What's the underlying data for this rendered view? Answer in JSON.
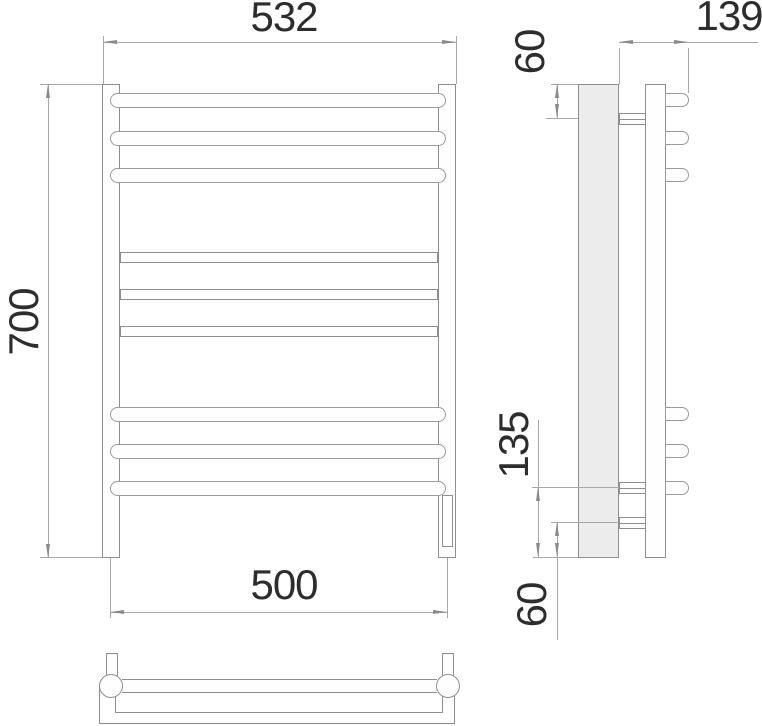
{
  "dimensions": {
    "front": {
      "overall_width": "532",
      "overall_height": "700",
      "mounting_width": "500"
    },
    "side": {
      "overall_depth": "139",
      "top_offset": "60",
      "lower_span": "135",
      "bottom_offset": "60"
    }
  }
}
